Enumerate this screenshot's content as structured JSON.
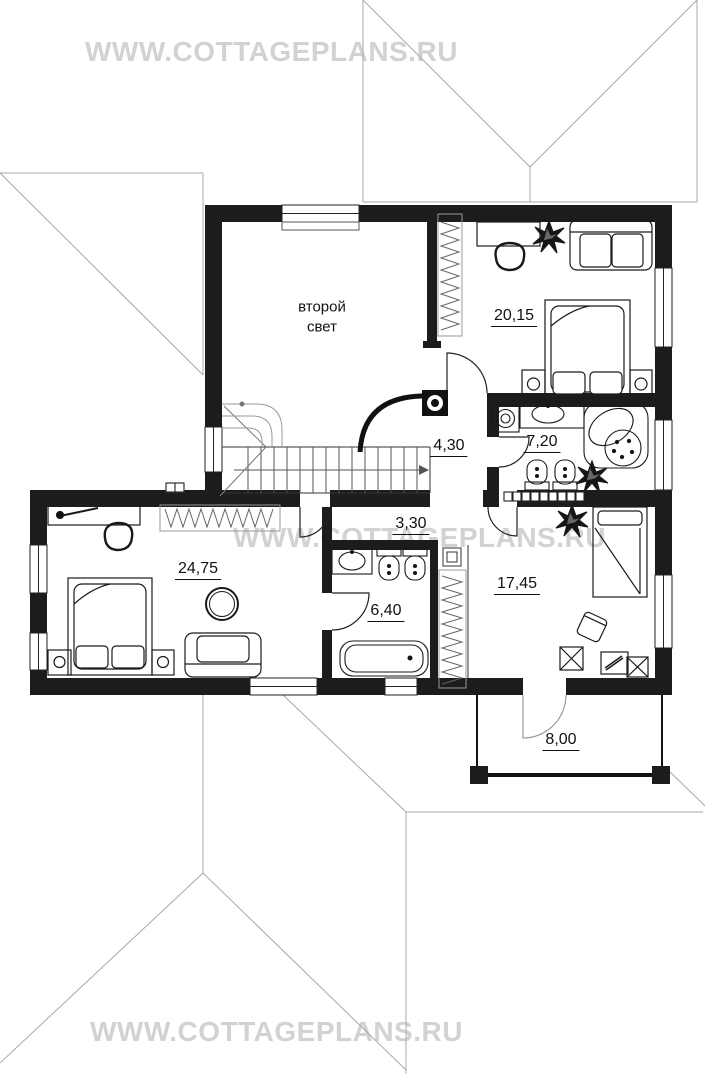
{
  "watermarks": {
    "top": "WWW.COTTAGEPLANS.RU",
    "middle": "WWW.COTTAGEPLANS.RU",
    "bottom": "WWW.COTTAGEPLANS.RU"
  },
  "plan": {
    "rooms": {
      "second_light": {
        "name": "второй\nсвет"
      },
      "bedroom_top": {
        "area": "20,15"
      },
      "hall": {
        "area": "4,30"
      },
      "bathroom_top": {
        "area": "7,20"
      },
      "corridor": {
        "area": "3,30"
      },
      "bedroom_left": {
        "area": "24,75"
      },
      "bathroom_bottom": {
        "area": "6,40"
      },
      "room_right": {
        "area": "17,45"
      },
      "terrace": {
        "area": "8,00"
      }
    }
  }
}
